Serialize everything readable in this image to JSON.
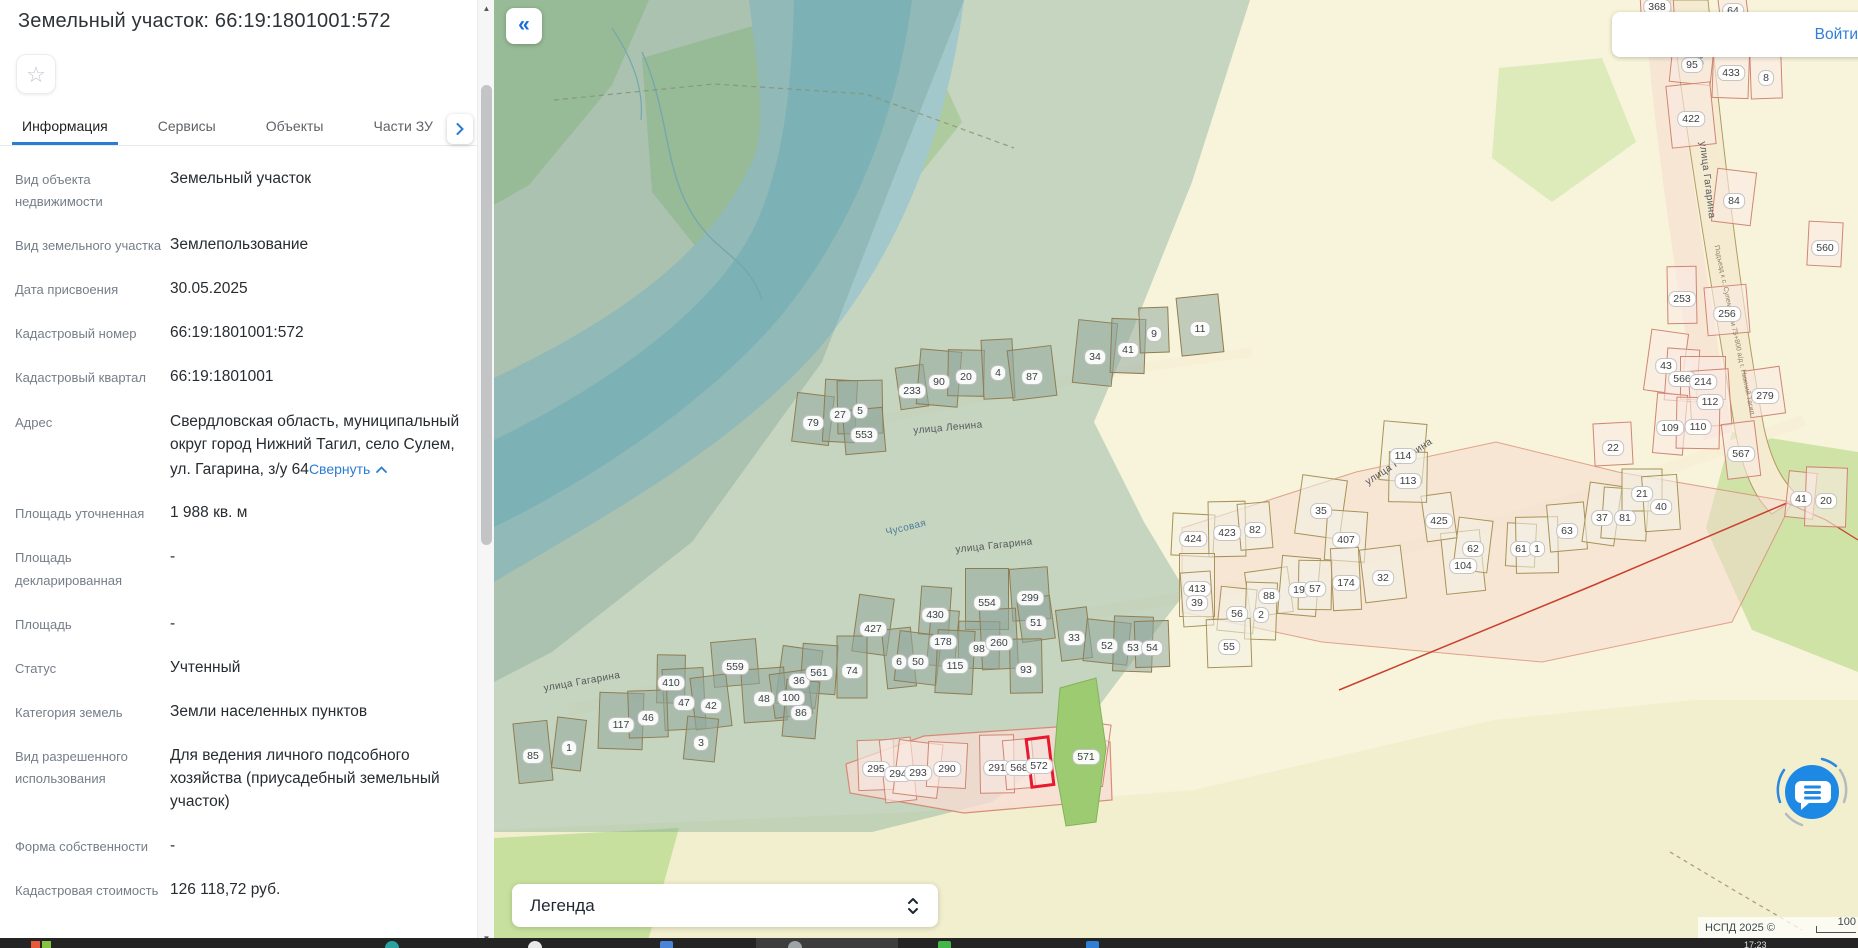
{
  "panel": {
    "title": "Земельный участок: 66:19:1801001:572",
    "favorite_icon": "☆",
    "tabs": [
      {
        "label": "Информация",
        "active": true
      },
      {
        "label": "Сервисы",
        "active": false
      },
      {
        "label": "Объекты",
        "active": false
      },
      {
        "label": "Части ЗУ",
        "active": false
      },
      {
        "label": "Состав",
        "active": false
      }
    ],
    "fields": [
      {
        "label": "Вид объекта недвижимости",
        "value": "Земельный участок"
      },
      {
        "label": "Вид земельного участка",
        "value": "Землепользование"
      },
      {
        "label": "Дата присвоения",
        "value": "30.05.2025"
      },
      {
        "label": "Кадастровый номер",
        "value": "66:19:1801001:572"
      },
      {
        "label": "Кадастровый квартал",
        "value": "66:19:1801001"
      },
      {
        "label": "Адрес",
        "value": "Свердловская область, муниципальный округ город Нижний Тагил, село Сулем, ул. Гагарина, з/у 64",
        "link": "Свернуть"
      },
      {
        "label": "Площадь уточненная",
        "value": "1 988 кв. м"
      },
      {
        "label": "Площадь декларированная",
        "value": "-"
      },
      {
        "label": "Площадь",
        "value": "-"
      },
      {
        "label": "Статус",
        "value": "Учтенный"
      },
      {
        "label": "Категория земель",
        "value": "Земли населенных пунктов"
      },
      {
        "label": "Вид разрешенного использования",
        "value": "Для ведения личного подсобного хозяйства (приусадебный земельный участок)"
      },
      {
        "label": "Форма собственности",
        "value": "-"
      },
      {
        "label": "Кадастровая стоимость",
        "value": "126 118,72 руб."
      }
    ]
  },
  "map": {
    "collapse_glyph": "«",
    "login_label": "Войти",
    "legend_label": "Легенда",
    "attribution": "НСПД 2025 ©",
    "scale_label": "100",
    "colors": {
      "accent": "#2b7cd3",
      "parcel_highlight": "#e8192c",
      "water": "#8fcbe9",
      "zone_teal": "#7aa896",
      "pink_zone": "#f6d8ce"
    },
    "streets": [
      {
        "text": "улица Ленина",
        "x": 454,
        "y": 428,
        "rot": -5,
        "type": "street"
      },
      {
        "text": "улица Гагарина",
        "x": 500,
        "y": 546,
        "rot": -6,
        "type": "street"
      },
      {
        "text": "улица Гагарина",
        "x": 88,
        "y": 682,
        "rot": -10,
        "type": "street"
      },
      {
        "text": "улица Гагарина",
        "x": 905,
        "y": 462,
        "rot": -33,
        "type": "street"
      },
      {
        "text": "улица Гагарина",
        "x": 1213,
        "y": 180,
        "rot": 83,
        "type": "street"
      },
      {
        "text": "Чусовая",
        "x": 412,
        "y": 528,
        "rot": -14,
        "type": "water"
      },
      {
        "text": "Чусовая",
        "x": 1205,
        "y": 45,
        "rot": 85,
        "type": "water"
      },
      {
        "text": "Подъезд к с. Сулем от км 75+800 а/д г. Нижний Тагил",
        "x": 1240,
        "y": 330,
        "rot": 78,
        "type": "tiny"
      }
    ],
    "badges": [
      [
        "233",
        418,
        391,
        "t"
      ],
      [
        "90",
        445,
        382,
        "t"
      ],
      [
        "20",
        472,
        377,
        "t"
      ],
      [
        "4",
        504,
        373,
        "t"
      ],
      [
        "87",
        538,
        377,
        "t"
      ],
      [
        "34",
        601,
        357,
        "t"
      ],
      [
        "41",
        634,
        350,
        "t"
      ],
      [
        "9",
        660,
        334,
        "t"
      ],
      [
        "11",
        706,
        329,
        "t"
      ],
      [
        "79",
        319,
        423,
        "t"
      ],
      [
        "27",
        346,
        415,
        "t"
      ],
      [
        "5",
        366,
        411,
        "t"
      ],
      [
        "553",
        370,
        435,
        "t"
      ],
      [
        "427",
        379,
        629,
        "t"
      ],
      [
        "430",
        441,
        615,
        "t"
      ],
      [
        "554",
        493,
        603,
        "t"
      ],
      [
        "299",
        536,
        598,
        "t"
      ],
      [
        "51",
        542,
        623,
        "t"
      ],
      [
        "178",
        449,
        642,
        "t"
      ],
      [
        "98",
        485,
        649,
        "t"
      ],
      [
        "260",
        505,
        643,
        "t"
      ],
      [
        "33",
        580,
        638,
        "t"
      ],
      [
        "52",
        613,
        646,
        "t"
      ],
      [
        "53",
        639,
        648,
        "t"
      ],
      [
        "54",
        658,
        648,
        "t"
      ],
      [
        "6",
        405,
        662,
        "t"
      ],
      [
        "50",
        424,
        662,
        "t"
      ],
      [
        "115",
        461,
        666,
        "t"
      ],
      [
        "93",
        532,
        670,
        "t"
      ],
      [
        "559",
        241,
        667,
        "t"
      ],
      [
        "36",
        305,
        681,
        "t"
      ],
      [
        "561",
        325,
        673,
        "t"
      ],
      [
        "74",
        358,
        671,
        "t"
      ],
      [
        "48",
        270,
        699,
        "t"
      ],
      [
        "100",
        297,
        698,
        "t"
      ],
      [
        "86",
        307,
        713,
        "t"
      ],
      [
        "410",
        177,
        683,
        "t"
      ],
      [
        "47",
        190,
        703,
        "t"
      ],
      [
        "42",
        217,
        706,
        "t"
      ],
      [
        "3",
        207,
        743,
        "t"
      ],
      [
        "117",
        127,
        725,
        "t"
      ],
      [
        "46",
        154,
        718,
        "t"
      ],
      [
        "85",
        39,
        756,
        "t"
      ],
      [
        "1",
        75,
        748,
        "t"
      ],
      [
        "424",
        699,
        539,
        "w"
      ],
      [
        "423",
        733,
        533,
        "w"
      ],
      [
        "82",
        761,
        530,
        "w"
      ],
      [
        "35",
        827,
        511,
        "w"
      ],
      [
        "407",
        852,
        540,
        "w"
      ],
      [
        "413",
        703,
        589,
        "w"
      ],
      [
        "39",
        703,
        603,
        "w"
      ],
      [
        "88",
        775,
        596,
        "w"
      ],
      [
        "19",
        805,
        590,
        "w"
      ],
      [
        "57",
        821,
        589,
        "w"
      ],
      [
        "174",
        852,
        583,
        "w"
      ],
      [
        "32",
        889,
        578,
        "w"
      ],
      [
        "56",
        743,
        614,
        "w"
      ],
      [
        "2",
        767,
        615,
        "w"
      ],
      [
        "55",
        735,
        647,
        "w"
      ],
      [
        "104",
        969,
        566,
        "w"
      ],
      [
        "62",
        979,
        549,
        "w"
      ],
      [
        "61",
        1027,
        549,
        "w"
      ],
      [
        "1",
        1043,
        549,
        "w"
      ],
      [
        "63",
        1073,
        531,
        "w"
      ],
      [
        "37",
        1108,
        518,
        "w"
      ],
      [
        "81",
        1131,
        518,
        "w"
      ],
      [
        "21",
        1148,
        494,
        "w"
      ],
      [
        "40",
        1167,
        507,
        "w"
      ],
      [
        "425",
        945,
        521,
        "w"
      ],
      [
        "114",
        909,
        456,
        "w"
      ],
      [
        "113",
        914,
        481,
        "w"
      ],
      [
        "368",
        1163,
        7,
        "p"
      ],
      [
        "64",
        1239,
        11,
        "p"
      ],
      [
        "95",
        1198,
        65,
        "p"
      ],
      [
        "433",
        1237,
        73,
        "p"
      ],
      [
        "8",
        1272,
        78,
        "p"
      ],
      [
        "422",
        1197,
        119,
        "p"
      ],
      [
        "84",
        1240,
        201,
        "p"
      ],
      [
        "560",
        1331,
        248,
        "p"
      ],
      [
        "253",
        1188,
        299,
        "p"
      ],
      [
        "256",
        1233,
        314,
        "p"
      ],
      [
        "43",
        1172,
        366,
        "p"
      ],
      [
        "566",
        1188,
        379,
        "p"
      ],
      [
        "214",
        1209,
        382,
        "p"
      ],
      [
        "112",
        1216,
        402,
        "p"
      ],
      [
        "279",
        1271,
        396,
        "p"
      ],
      [
        "109",
        1176,
        428,
        "p"
      ],
      [
        "110",
        1204,
        427,
        "p"
      ],
      [
        "22",
        1119,
        448,
        "p"
      ],
      [
        "567",
        1247,
        454,
        "p"
      ],
      [
        "41",
        1307,
        499,
        "p"
      ],
      [
        "20",
        1332,
        501,
        "p"
      ],
      [
        "295",
        382,
        769,
        "p"
      ],
      [
        "294",
        404,
        774,
        "p"
      ],
      [
        "293",
        424,
        773,
        "p"
      ],
      [
        "290",
        453,
        769,
        "p"
      ],
      [
        "291",
        503,
        768,
        "p"
      ],
      [
        "568",
        525,
        768,
        "p"
      ],
      [
        "571",
        592,
        757,
        "p"
      ],
      [
        "572",
        545,
        766,
        "r"
      ]
    ]
  },
  "taskbar": {
    "clock": "17:23"
  }
}
